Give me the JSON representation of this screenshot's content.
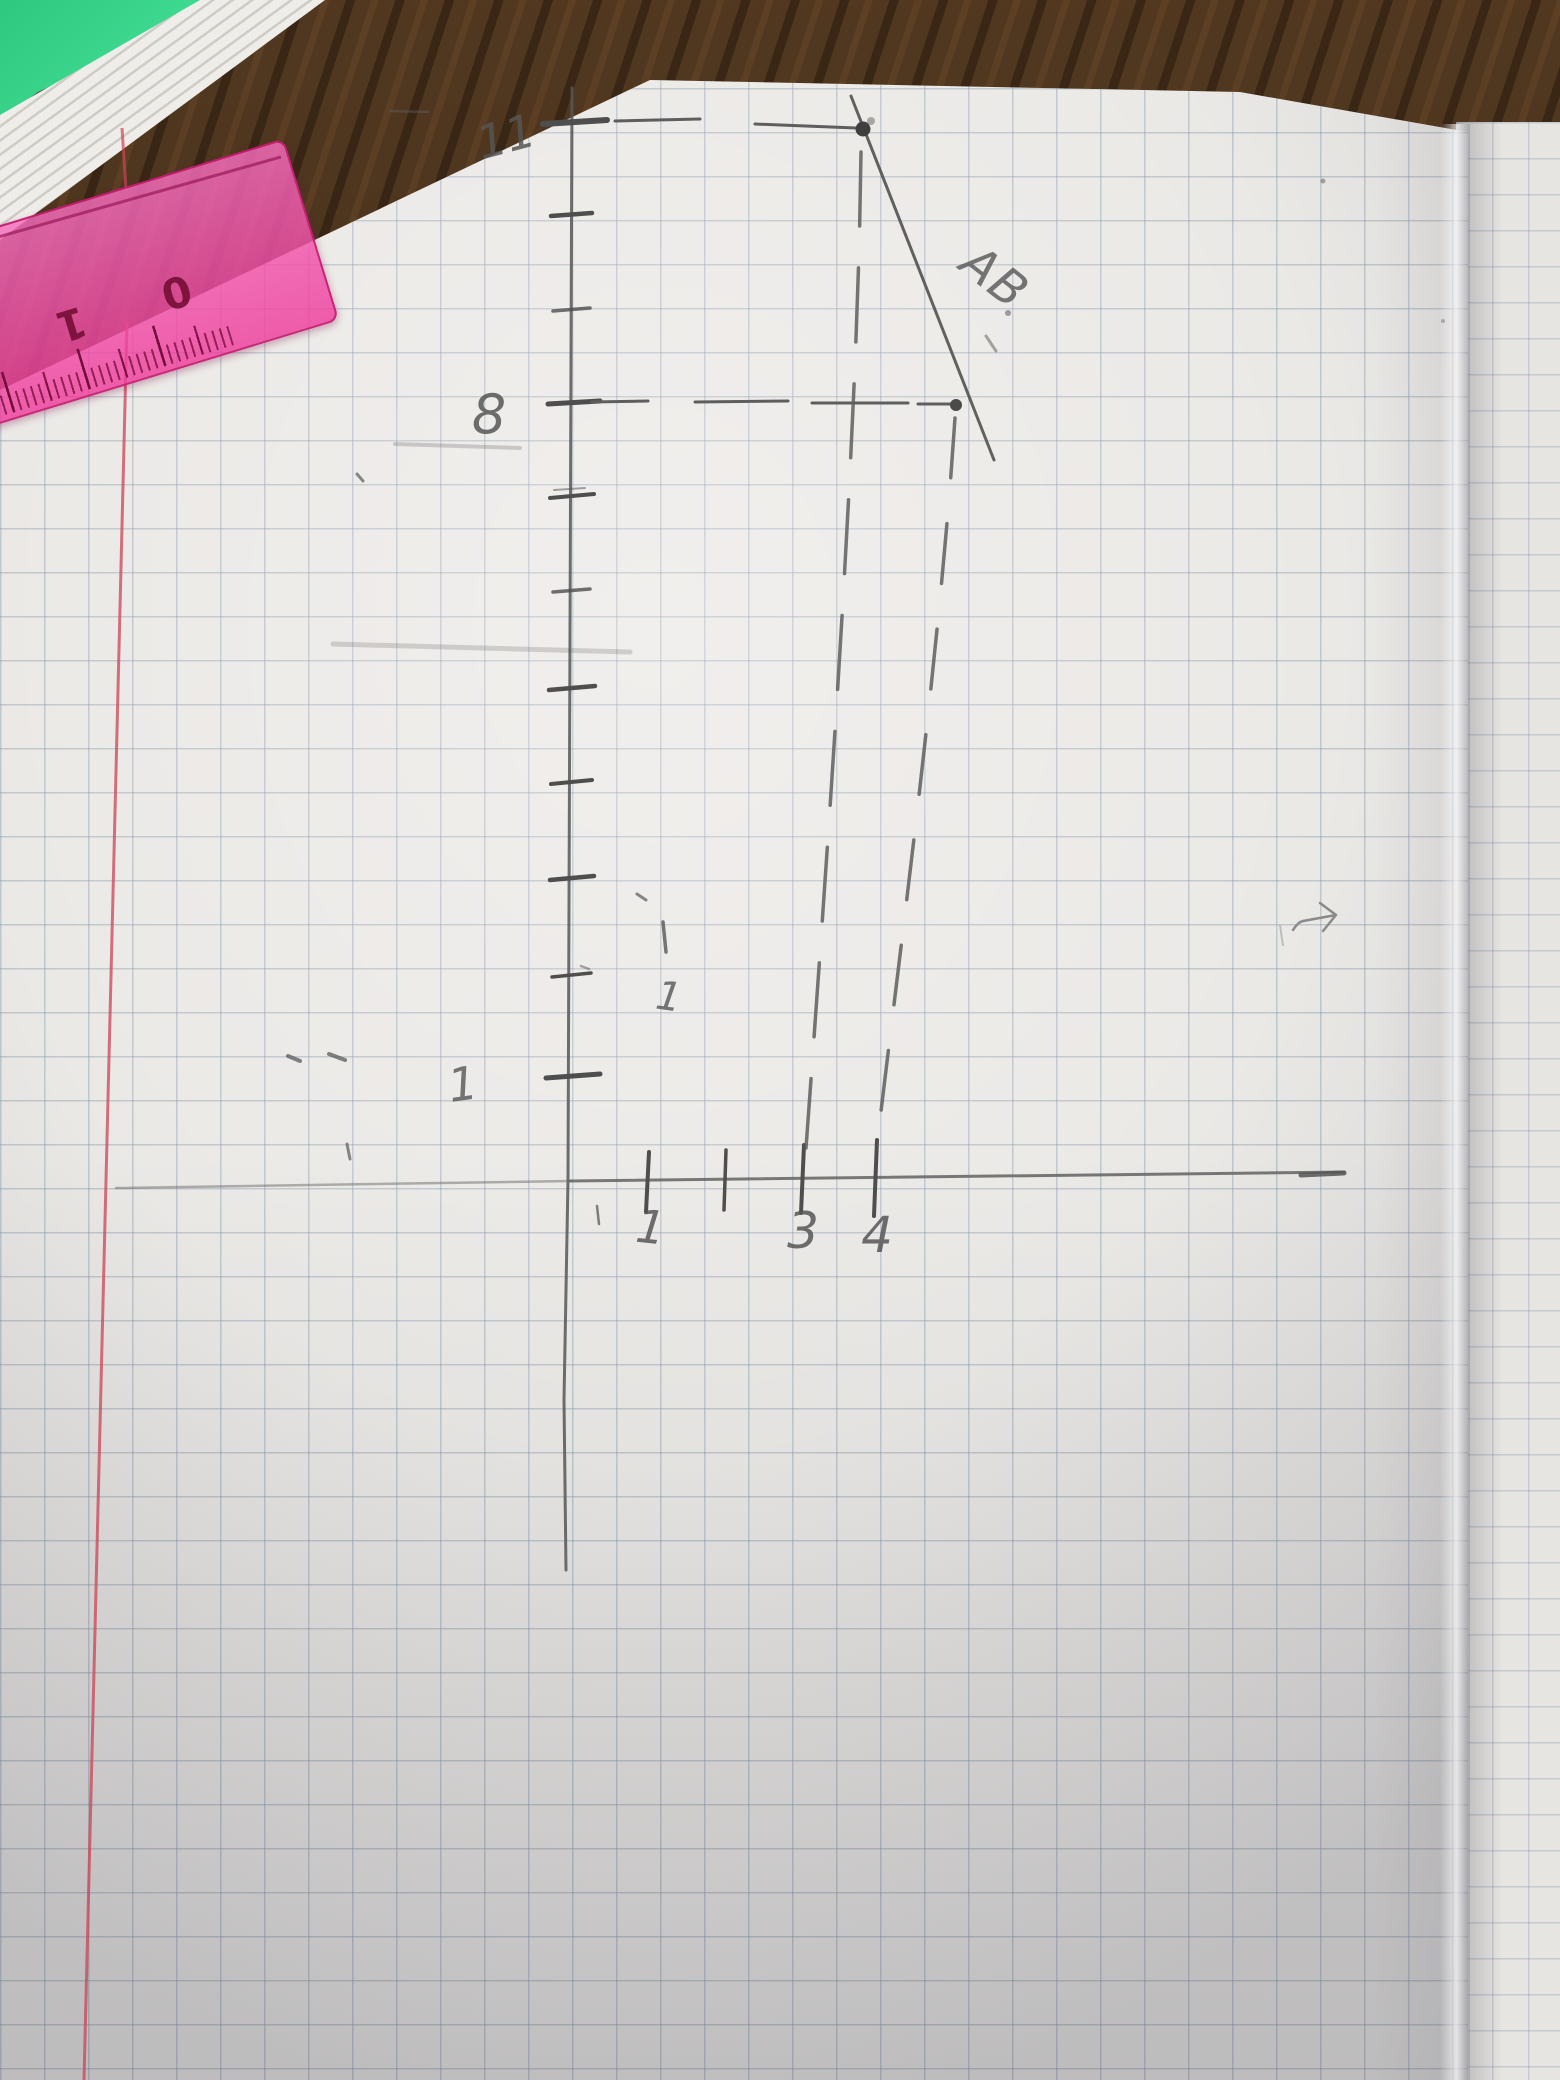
{
  "graph": {
    "labels": {
      "y11": "11",
      "y8": "8",
      "y1": "1",
      "x1": "1",
      "x3": "3",
      "x4": "4",
      "segment": "AB",
      "stray": "1"
    },
    "points": {
      "A": {
        "x": 3,
        "y": 11
      },
      "B": {
        "x": 4,
        "y": 8
      }
    }
  },
  "ruler": {
    "numbers": [
      "2",
      "1",
      "0"
    ],
    "brand_mark": "B"
  },
  "colors": {
    "ruler_pink": "#ee3c9b",
    "margin_red": "#cc4456",
    "pencil_gray": "#565656",
    "desk_brown": "#4c3520",
    "paper": "#ebe9e6",
    "grid_line": "#7f93a8",
    "notebook_green": "#35d98a"
  }
}
